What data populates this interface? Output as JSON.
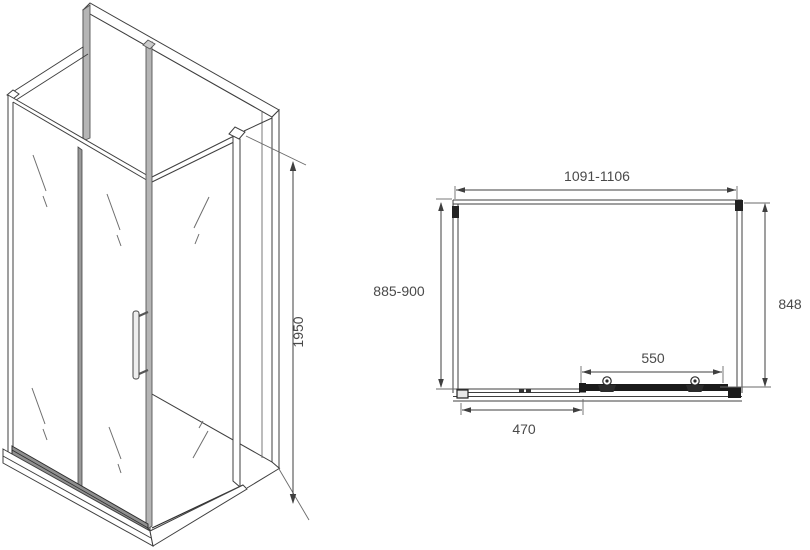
{
  "side_view": {
    "name": "shower-enclosure-isometric-view",
    "height": "1950"
  },
  "plan_view": {
    "name": "shower-enclosure-top-plan-view",
    "width": "1091-1106",
    "depth_left": "885-900",
    "depth_right": "848",
    "door_width": "550",
    "bottom_rail": "470"
  },
  "colors": {
    "line": "#3f3f3f",
    "text": "#4a4a4a",
    "profile_gray": "#b5b5b5",
    "background": "#ffffff"
  }
}
